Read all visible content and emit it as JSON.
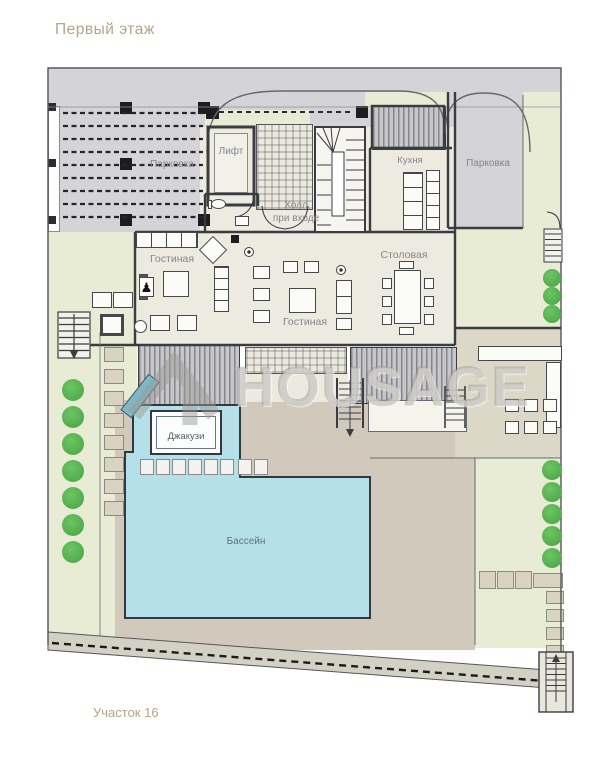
{
  "title": "Первый этаж",
  "plot_label": "Участок 16",
  "watermark": "HOUSAGE",
  "rooms": {
    "parking_left": "Парковка",
    "parking_right": "Парковка",
    "elevator": "Лифт",
    "kitchen": "Кухня",
    "hall": "Холл\nпри входе",
    "living_left": "Гостиная",
    "living_center": "Гостиная",
    "dining": "Столовая",
    "jacuzzi": "Джакузи",
    "pool": "Бассейн"
  },
  "colors": {
    "pool_water": "#b5dfe9",
    "lawn": "#e8ecd5",
    "paving": "#d4d4d8",
    "house_floor": "#edebdf",
    "terrace": "#d2c9bd",
    "tree": "#57b853",
    "title_text": "#b5a385",
    "label_text": "#84858b"
  }
}
